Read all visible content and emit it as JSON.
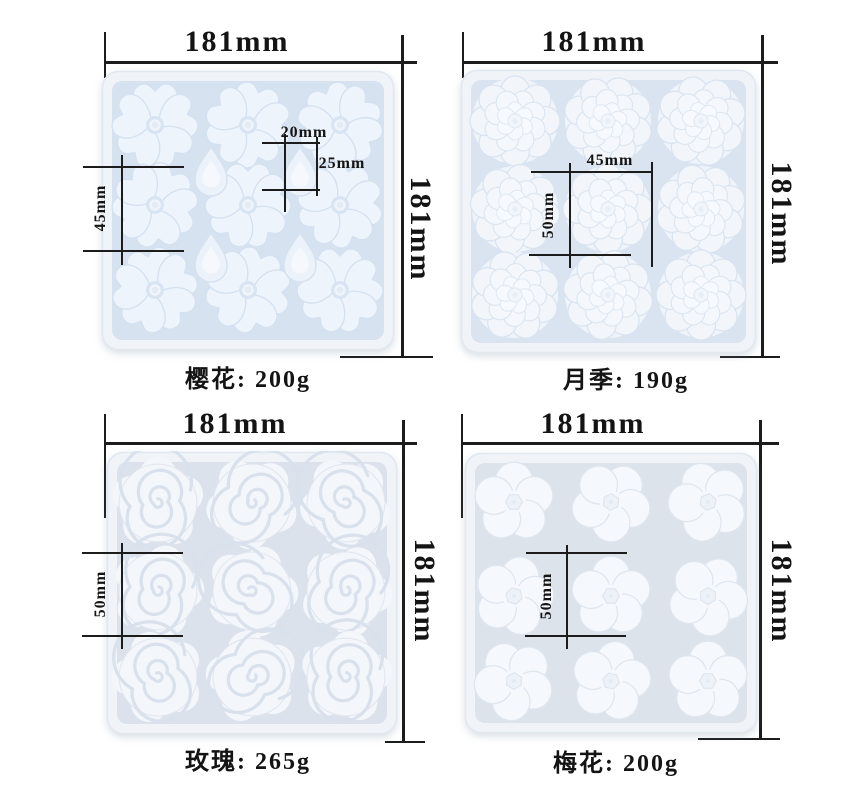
{
  "colors": {
    "background": "#ffffff",
    "dimension_line": "#1c1c1c",
    "dimension_text": "#141414",
    "tray_rim": "#f0f4f9",
    "tray_base_blue": "#d7e2f0",
    "flower_white": "#f4f7fb"
  },
  "panels": [
    {
      "id": "sakura",
      "flower": "cherry-blossom",
      "label": "樱花: 200g",
      "cavities": 9,
      "drop_cavities": 4,
      "dims": {
        "width": "181mm",
        "height": "181mm",
        "flower_height": "45mm",
        "drop_width": "20mm",
        "drop_height": "25mm"
      }
    },
    {
      "id": "rose-tea",
      "flower": "chinese-rose",
      "label": "月季: 190g",
      "cavities": 9,
      "dims": {
        "width": "181mm",
        "height": "181mm",
        "flower_width": "45mm",
        "flower_height": "50mm"
      }
    },
    {
      "id": "rose",
      "flower": "rose",
      "label": "玫瑰: 265g",
      "cavities": 9,
      "dims": {
        "width": "181mm",
        "height": "181mm",
        "flower_height": "50mm"
      }
    },
    {
      "id": "plum",
      "flower": "plum-blossom",
      "label": "梅花: 200g",
      "cavities": 9,
      "dims": {
        "width": "181mm",
        "height": "181mm",
        "flower_height": "50mm"
      }
    }
  ]
}
